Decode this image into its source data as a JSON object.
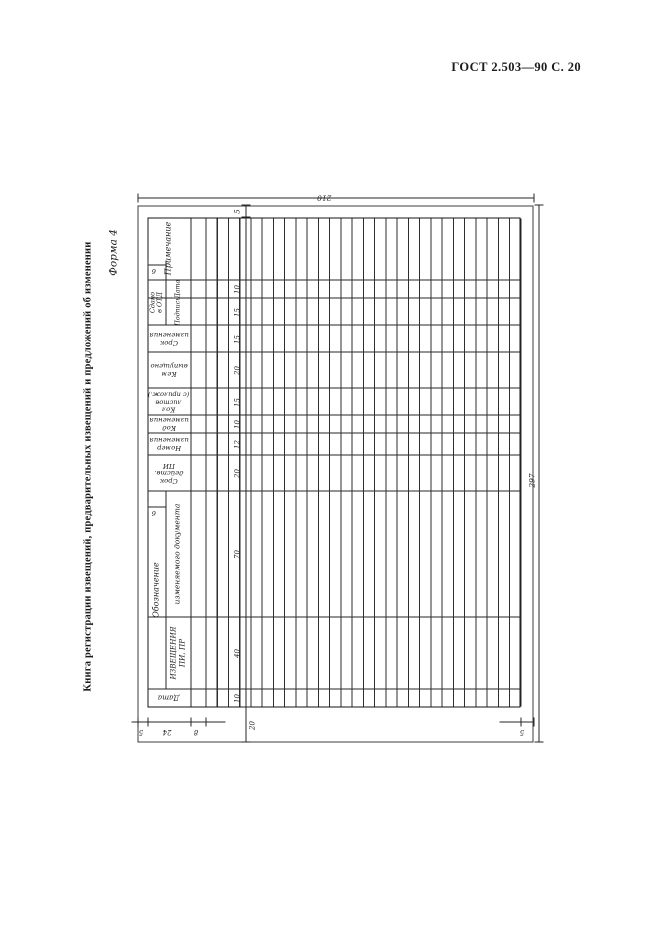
{
  "page": {
    "header": "ГОСТ 2.503—90 С. 20",
    "form_label": "Форма 4",
    "side_caption": "Книга регистрации извещений, предварительных извещений и предложений об изменении"
  },
  "table": {
    "headers": {
      "date": "Дата",
      "designation_group": "Обозначение",
      "notice": "ИЗВЕЩЕНИЯ\nПИ, ПР",
      "changed_doc": "изменяемого документа",
      "pi_validity": "Срок\nдейств.\nПИ",
      "change_number": "Номер\nизменения",
      "change_code": "Код\nизменения",
      "sheet_count": "Кол\nлистов\n(с прилож.)",
      "issued_by": "Кем\nвыпущено",
      "change_term": "Срок\nизменения",
      "submitted_group": "Сдано\nв ОТД",
      "signature": "Подпись",
      "date2": "Дата",
      "note": "Примечание"
    }
  },
  "dimensions": {
    "sheet_width": "210",
    "sheet_height": "297",
    "top_margin": "5",
    "left_margin": "20",
    "right_margin": "5",
    "bottom_margin": "5",
    "header_height": "24",
    "subrow_height": "8",
    "small_cell": "6",
    "col_date": "10",
    "col_notice": "40",
    "col_changed_doc": "70",
    "col_pi": "20",
    "col_number": "12",
    "col_code": "10",
    "col_sheets": "15",
    "col_issued": "20",
    "col_term": "15",
    "col_sig": "15",
    "col_date2": "10"
  }
}
